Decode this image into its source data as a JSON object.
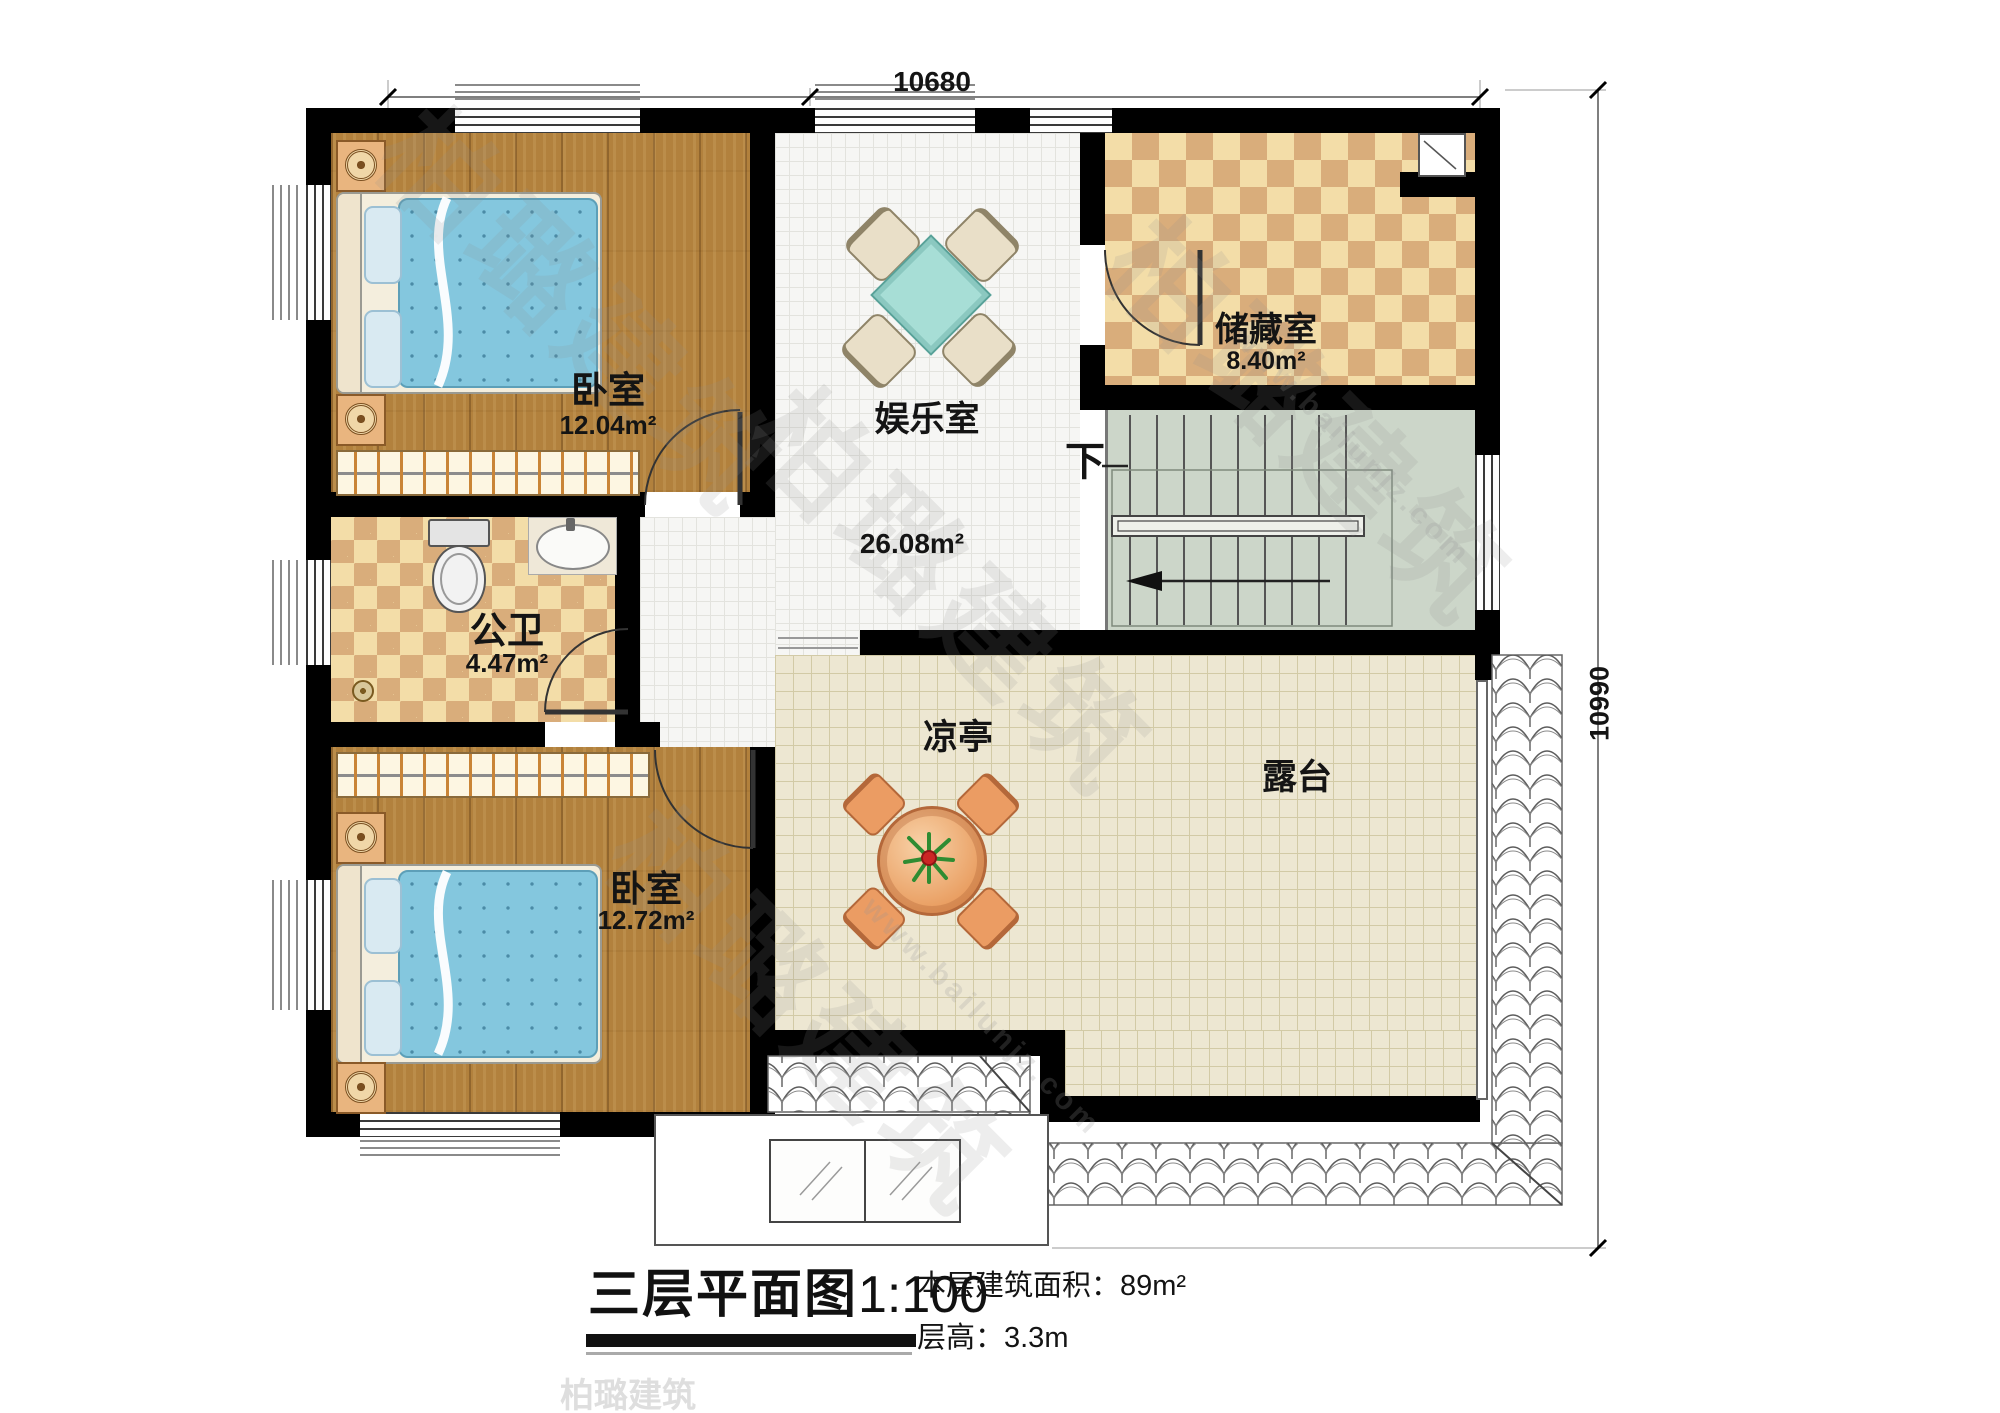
{
  "dimensions": {
    "width_label": "10680",
    "height_label": "10990"
  },
  "rooms": {
    "bedroom_top": {
      "name": "卧室",
      "area": "12.04m²"
    },
    "entertainment": {
      "name": "娱乐室",
      "area": "26.08m²"
    },
    "storage": {
      "name": "储藏室",
      "area": "8.40m²"
    },
    "bathroom": {
      "name": "公卫",
      "area": "4.47m²"
    },
    "bedroom_bottom": {
      "name": "卧室",
      "area": "12.72m²"
    },
    "pavilion": {
      "name": "凉亭"
    },
    "terrace": {
      "name": "露台"
    }
  },
  "stair": {
    "direction_label": "下"
  },
  "title": {
    "name": "三层平面图",
    "scale": "1:100",
    "area_note": "本层建筑面积：89m²",
    "floor_height_note": "层高：3.3m"
  },
  "watermark": {
    "brand": "柏璐建筑",
    "site": "www.bailunjz.com"
  },
  "colors": {
    "wall": "#000000",
    "wood_floor": "#b2813d",
    "checker_light": "#f3dda8",
    "checker_dark": "#d9ad7b",
    "terrace_tile": "#ede7d2",
    "stair_floor": "#ccd6c9",
    "bed_blue": "#84c7de",
    "table_teal": "#a7ded6",
    "table_orange": "#e89a5c"
  }
}
